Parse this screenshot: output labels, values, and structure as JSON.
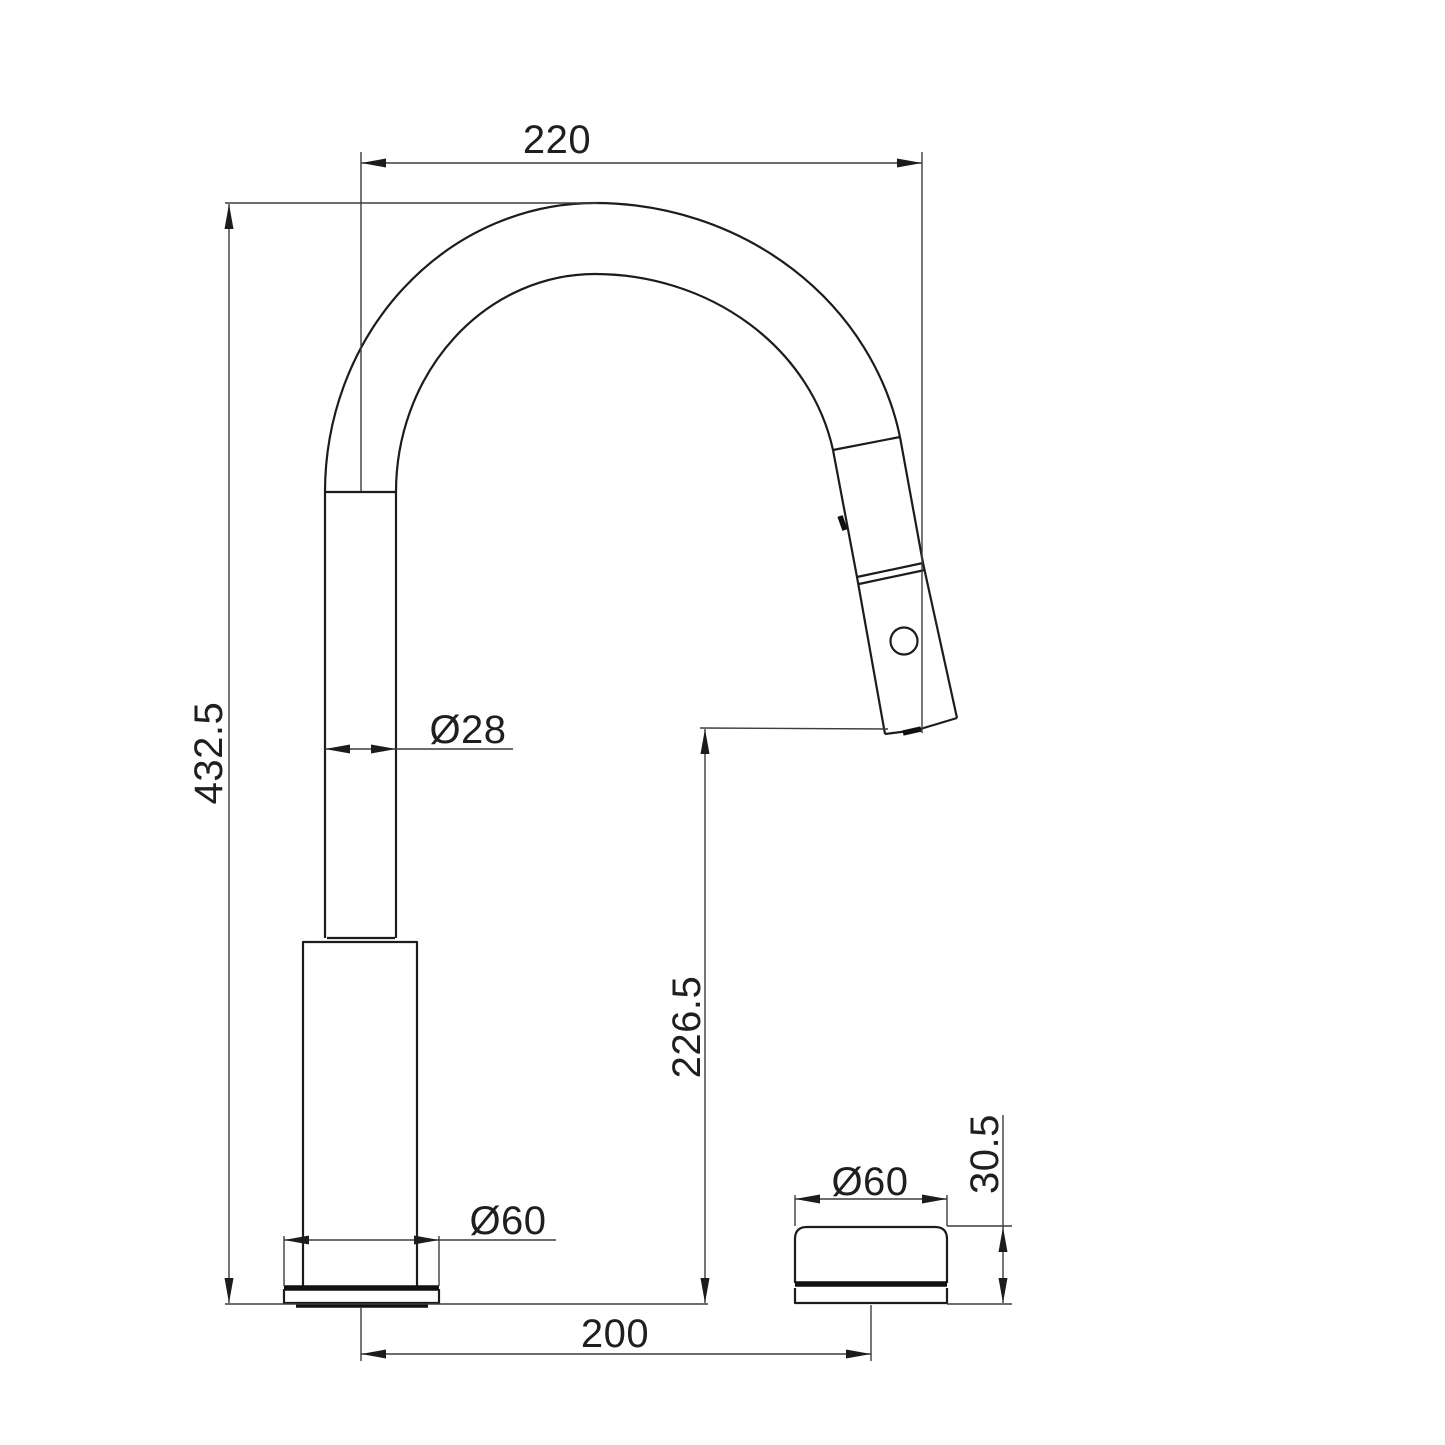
{
  "drawing": {
    "type": "faucet-technical-drawing",
    "background_color": "#ffffff",
    "line_color": "#1c1c1c",
    "labels": {
      "spout_reach": "220",
      "overall_height": "432.5",
      "spout_tube_diameter": "Ø28",
      "outlet_height": "226.5",
      "base_diameter": "Ø60",
      "centres_distance": "200",
      "handle_diameter": "Ø60",
      "handle_height": "30.5"
    }
  }
}
